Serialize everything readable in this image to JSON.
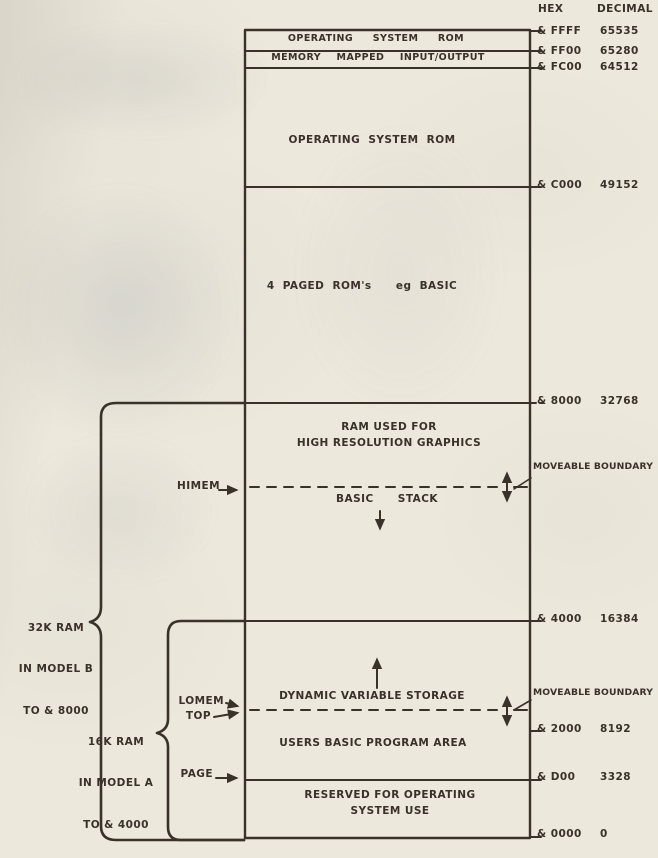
{
  "headers": {
    "hex": "HEX",
    "decimal": "DECIMAL"
  },
  "addresses": [
    {
      "hex": "& FFFF",
      "decimal": "65535"
    },
    {
      "hex": "& FF00",
      "decimal": "65280"
    },
    {
      "hex": "& FC00",
      "decimal": "64512"
    },
    {
      "hex": "& C000",
      "decimal": "49152"
    },
    {
      "hex": "& 8000",
      "decimal": "32768"
    },
    {
      "hex": "& 4000",
      "decimal": "16384"
    },
    {
      "hex": "& 2000",
      "decimal": "8192"
    },
    {
      "hex": "& D00",
      "decimal": "3328"
    },
    {
      "hex": "& 0000",
      "decimal": "0"
    }
  ],
  "sections": {
    "os_rom_top": "OPERATING  SYSTEM  ROM",
    "memory_mapped_io": "MEMORY  MAPPED  INPUT/OUTPUT",
    "os_rom": "OPERATING SYSTEM ROM",
    "paged_roms": "4 PAGED ROM's   eg BASIC",
    "hires_line1": "RAM USED FOR",
    "hires_line2": "HIGH RESOLUTION GRAPHICS",
    "basic_stack": "BASIC  STACK",
    "dynamic_vars": "DYNAMIC VARIABLE STORAGE",
    "users_basic": "USERS BASIC PROGRAM AREA",
    "reserved_line1": "RESERVED FOR OPERATING",
    "reserved_line2": "SYSTEM USE"
  },
  "pointers": {
    "himem": "HIMEM",
    "lomem": "LOMEM",
    "top": "TOP",
    "page": "PAGE"
  },
  "annotations": {
    "moveable_boundary_upper": "MOVEABLE BOUNDARY",
    "moveable_boundary_lower": "MOVEABLE BOUNDARY",
    "ram32k": {
      "line1": "32K RAM",
      "line2": "IN MODEL B",
      "line3": "TO & 8000"
    },
    "ram16k": {
      "line1": "16K RAM",
      "line2": "IN MODEL A",
      "line3": "TO & 4000"
    }
  }
}
